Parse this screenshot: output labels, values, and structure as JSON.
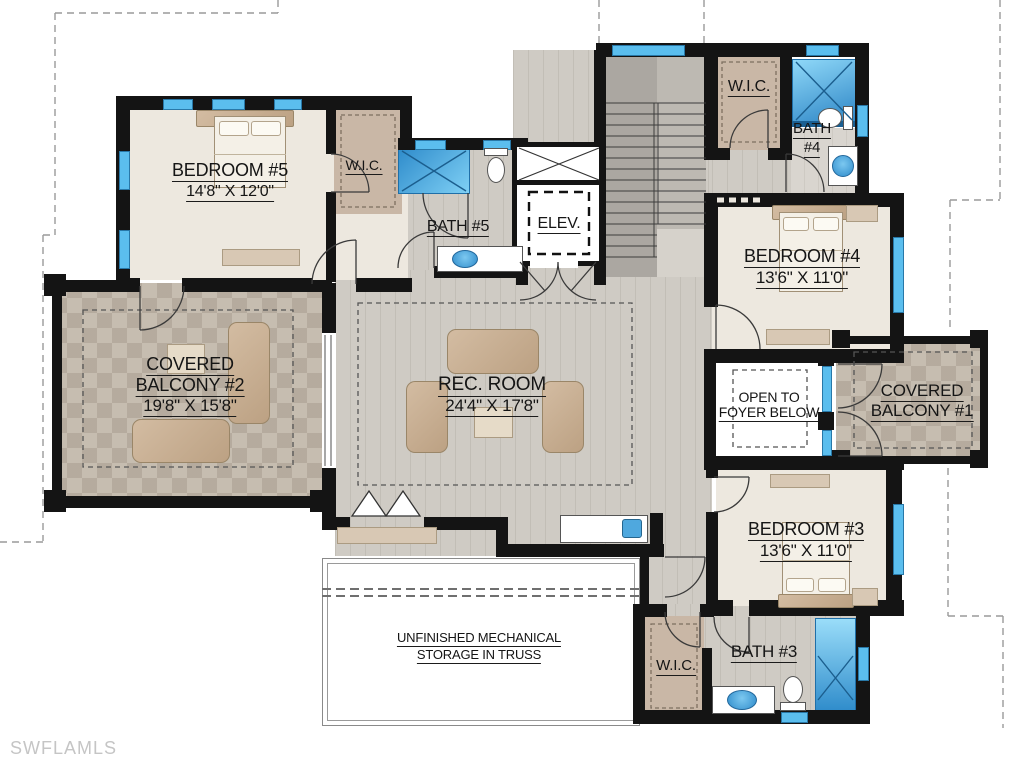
{
  "title": "Second floor residential floor plan",
  "watermark": "SWFLAMLS",
  "rooms": {
    "bedroom5": {
      "name": "BEDROOM #5",
      "dims": "14'8\" X 12'0\""
    },
    "wic5": {
      "name": "W.I.C."
    },
    "bath5": {
      "name": "BATH #5"
    },
    "elevator": {
      "name": "ELEV."
    },
    "wic4": {
      "name": "W.I.C."
    },
    "bath4": {
      "name": "BATH",
      "number": "#4"
    },
    "bedroom4": {
      "name": "BEDROOM #4",
      "dims": "13'6\" X 11'0\""
    },
    "balcony2": {
      "line1": "COVERED",
      "line2": "BALCONY #2",
      "dims": "19'8\" X 15'8\""
    },
    "rec_room": {
      "name": "REC. ROOM",
      "dims": "24'4\" X 17'8\""
    },
    "foyer": {
      "line1": "OPEN TO",
      "line2": "FOYER BELOW"
    },
    "balcony1": {
      "line1": "COVERED",
      "line2": "BALCONY #1"
    },
    "bedroom3": {
      "name": "BEDROOM #3",
      "dims": "13'6\" X 11'0\""
    },
    "wic3": {
      "name": "W.I.C."
    },
    "bath3": {
      "name": "BATH #3"
    },
    "storage": {
      "line1": "UNFINISHED MECHANICAL",
      "line2": "STORAGE IN TRUSS"
    }
  },
  "colors": {
    "wall": "#141414",
    "window_blue": "#5BBEEE",
    "shower_blue_dark": "#2F8CCB",
    "shower_blue_light": "#8FD6F7",
    "room_cream": "#EDE8DF",
    "wic_tan": "#C9B7A6",
    "wood_floor": "#CFCBC4",
    "stone_tile": "#C6BDB0",
    "furniture_tan": "#C9B096",
    "watermark_gray": "#C5C5C5"
  }
}
